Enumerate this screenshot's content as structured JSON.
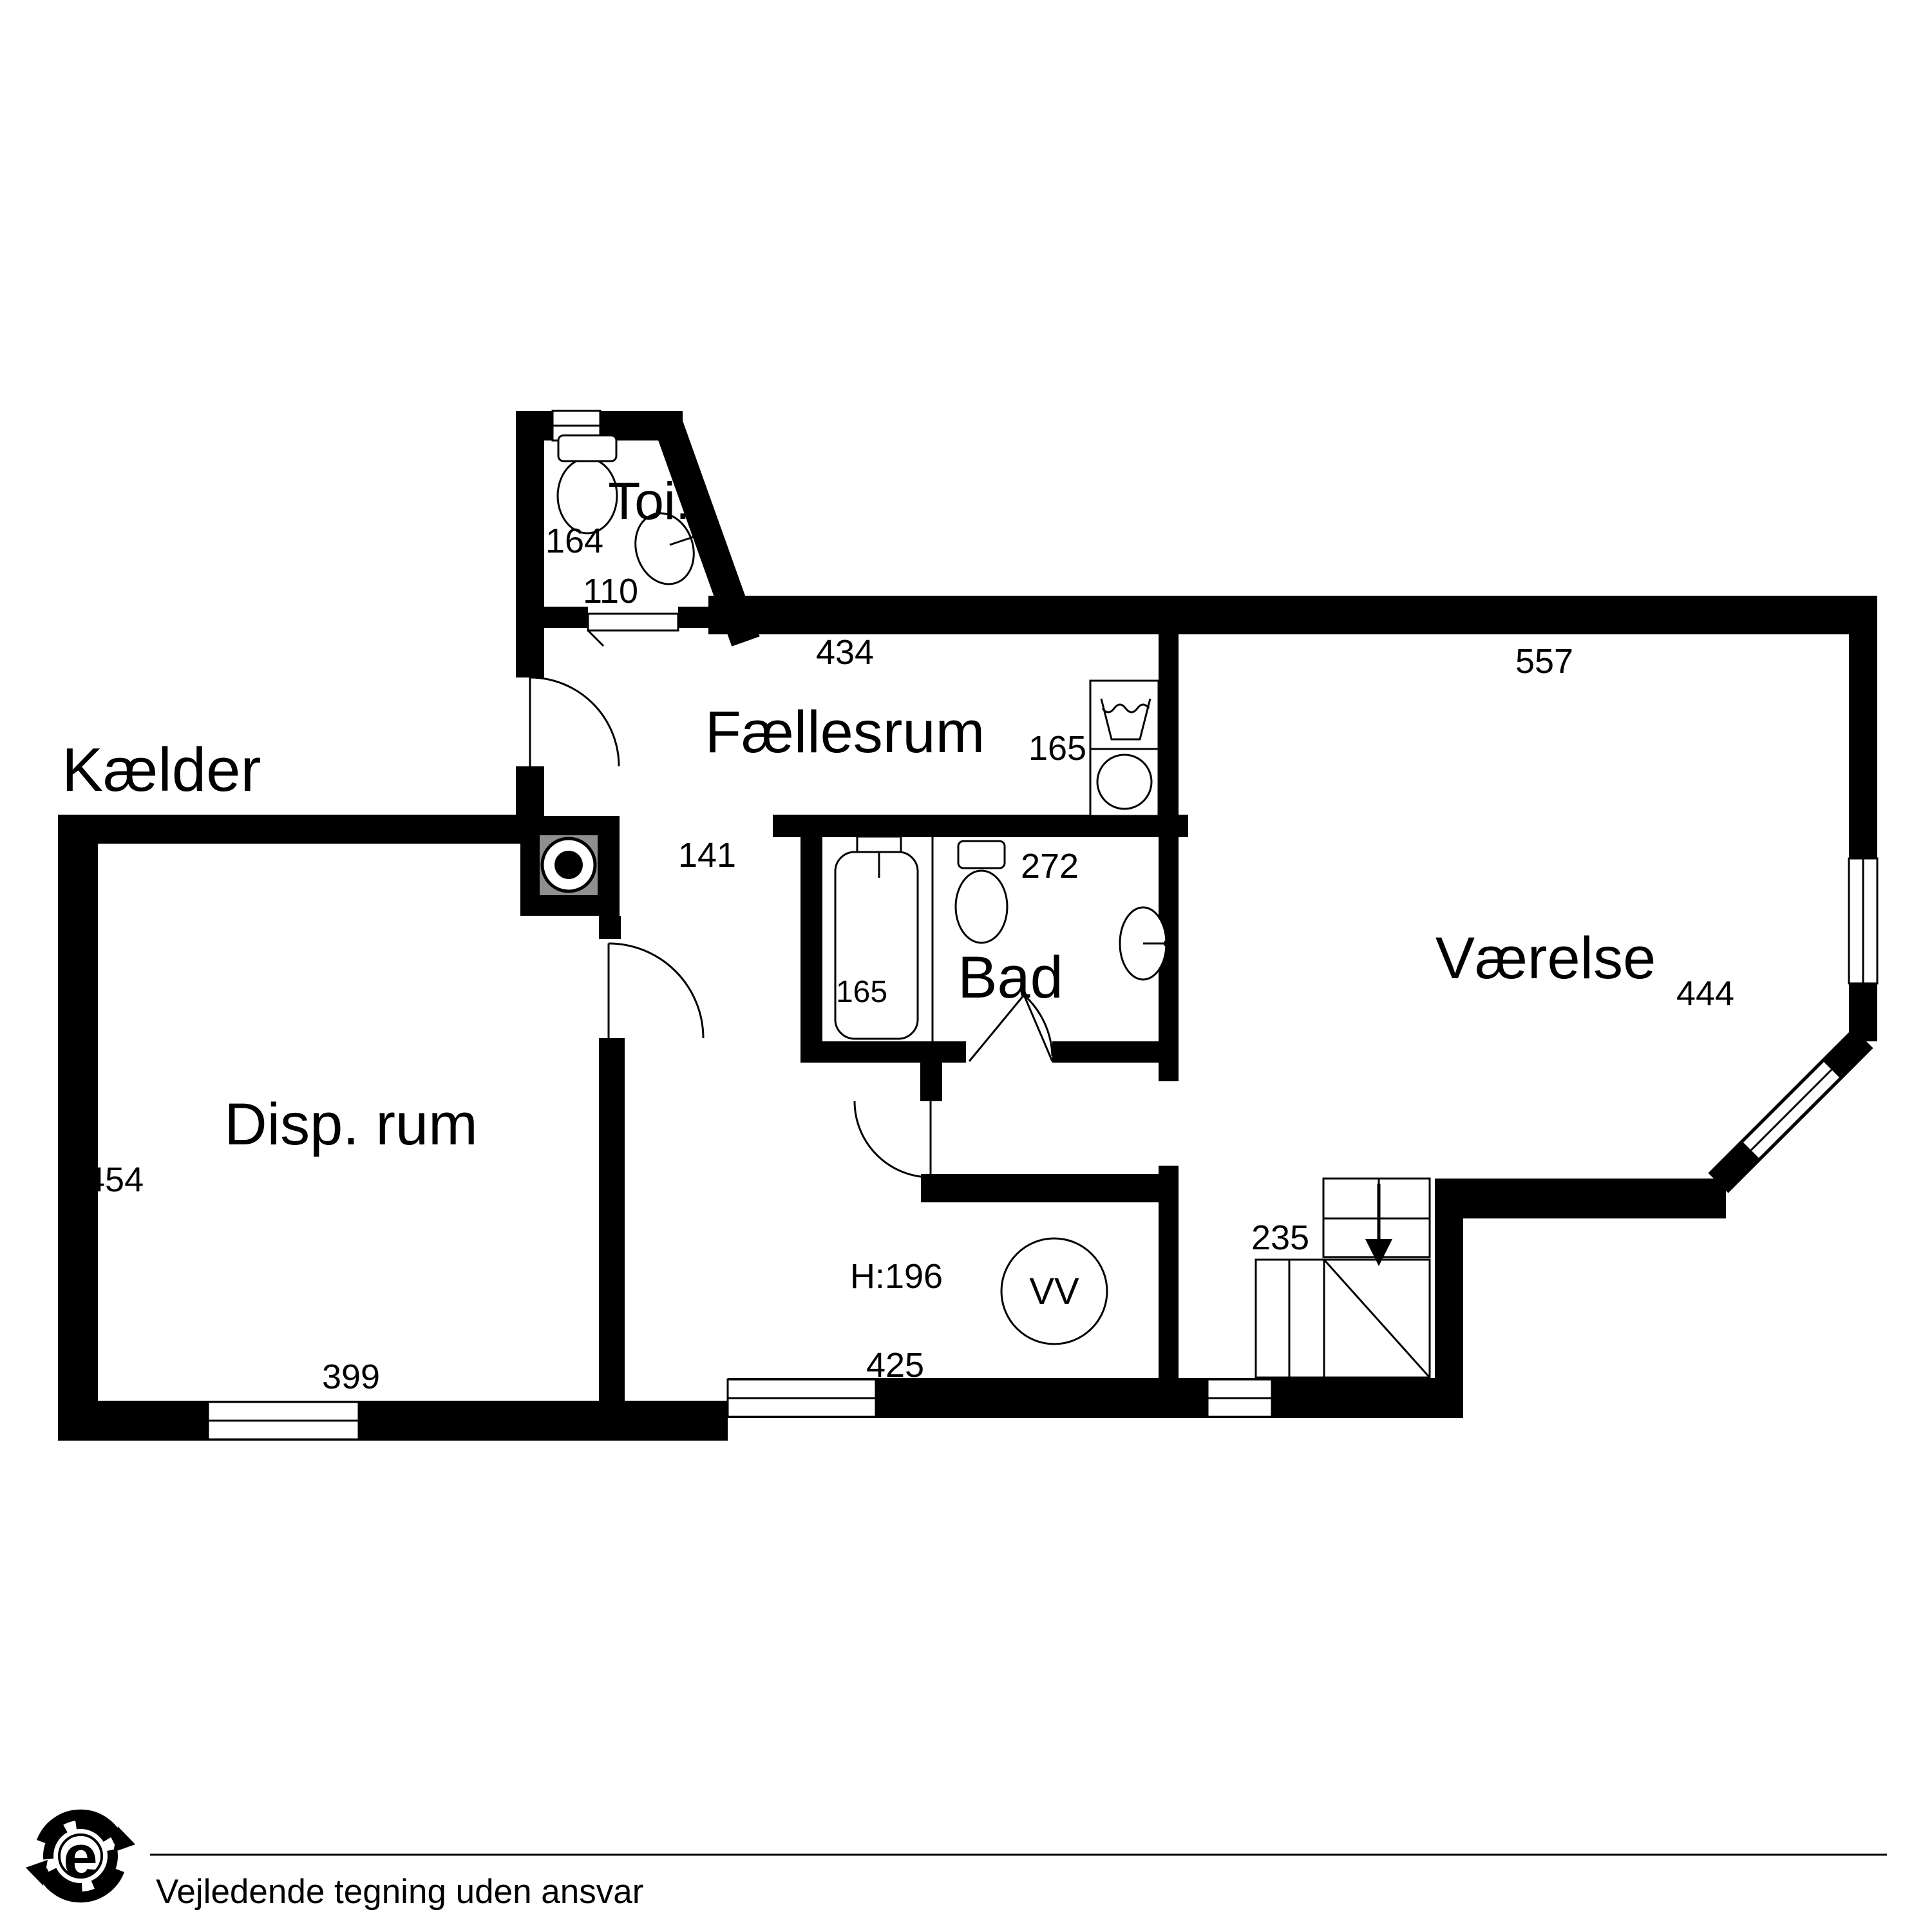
{
  "title": "Kælder",
  "rooms": {
    "toi": "Toi.",
    "faellesrum": "Fællesrum",
    "bad": "Bad",
    "vaerelse": "Værelse",
    "disp": "Disp. rum"
  },
  "dims": {
    "toi_width": "164",
    "toi_door": "110",
    "faellesrum_top": "434",
    "vaerelse_top": "557",
    "washer_side": "165",
    "bad_top": "272",
    "passage": "141",
    "bathtub": "165",
    "vaerelse_side": "444",
    "disp_side": "454",
    "disp_bottom": "399",
    "hall_bottom": "425",
    "stairs": "235"
  },
  "annotations": {
    "ceiling_height": "H:196",
    "hot_water": "VV"
  },
  "footer": {
    "disclaimer": "Vejledende tegning uden ansvar",
    "logo_letter": "e"
  },
  "colors": {
    "wall": "#000000",
    "chimney": "#8f8f8f",
    "background": "#ffffff"
  }
}
